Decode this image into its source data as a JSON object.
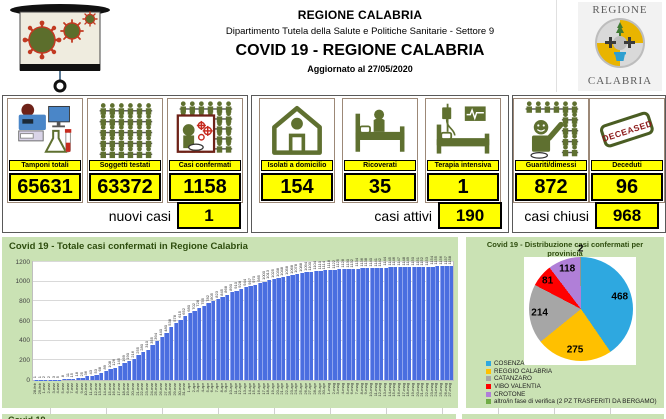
{
  "header": {
    "org": "REGIONE CALABRIA",
    "dept": "Dipartimento Tutela della Salute e Politiche Sanitarie - Settore 9",
    "title": "COVID 19 - REGIONE CALABRIA",
    "updated": "Aggiornato al  27/05/2020",
    "logo_top": "REGIONE",
    "logo_bottom": "CALABRIA"
  },
  "colors": {
    "accent_yellow": "#ffff00",
    "panel_green": "#cae2b4",
    "icon_olive": "#5f7030",
    "stamp_red": "#8c1a1a"
  },
  "stat_groups": [
    {
      "boxes": [
        {
          "label": "Tamponi totali",
          "value": "65631",
          "icon": "lab-equipment-icon"
        },
        {
          "label": "Soggetti testati",
          "value": "63372",
          "icon": "people-grid-icon"
        },
        {
          "label": "Casi confermati",
          "value": "1158",
          "icon": "coughing-person-icon"
        }
      ],
      "summary": {
        "label": "nuovi casi",
        "value": "1"
      }
    },
    {
      "boxes": [
        {
          "label": "Isolati a domicilio",
          "value": "154",
          "icon": "house-icon"
        },
        {
          "label": "Ricoverati",
          "value": "35",
          "icon": "hospital-bed-icon"
        },
        {
          "label": "Terapia intensiva",
          "value": "1",
          "icon": "intensive-care-icon"
        }
      ],
      "summary": {
        "label": "casi attivi",
        "value": "190"
      }
    },
    {
      "boxes": [
        {
          "label": "Guariti/dimessi",
          "value": "872",
          "icon": "recovered-person-icon"
        },
        {
          "label": "Deceduti",
          "value": "96",
          "icon": "deceased-stamp-icon"
        }
      ],
      "summary": {
        "label": "casi chiusi",
        "value": "968"
      }
    }
  ],
  "chart_data": [
    {
      "type": "bar",
      "title": "Covid 19 - Totale casi confermati in Regione Calabria",
      "ylim": [
        0,
        1200
      ],
      "ytick_step": 200,
      "grid": true,
      "data_labels": true,
      "bar_color": "#4a6ee0",
      "categories": [
        "28-feb",
        "29-feb",
        "1-mar",
        "2-mar",
        "3-mar",
        "4-mar",
        "5-mar",
        "6-mar",
        "7-mar",
        "8-mar",
        "9-mar",
        "10-mar",
        "11-mar",
        "12-mar",
        "13-mar",
        "14-mar",
        "15-mar",
        "16-mar",
        "17-mar",
        "18-mar",
        "19-mar",
        "20-mar",
        "21-mar",
        "22-mar",
        "23-mar",
        "24-mar",
        "25-mar",
        "26-mar",
        "27-mar",
        "28-mar",
        "29-mar",
        "30-mar",
        "31-mar",
        "1-apr",
        "2-apr",
        "3-apr",
        "4-apr",
        "5-apr",
        "6-apr",
        "7-apr",
        "8-apr",
        "9-apr",
        "10-apr",
        "11-apr",
        "12-apr",
        "13-apr",
        "14-apr",
        "15-apr",
        "16-apr",
        "17-apr",
        "18-apr",
        "19-apr",
        "20-apr",
        "21-apr",
        "22-apr",
        "23-apr",
        "24-apr",
        "25-apr",
        "26-apr",
        "27-apr",
        "28-apr",
        "29-apr",
        "30-apr",
        "1-mag",
        "2-mag",
        "3-mag",
        "4-mag",
        "5-mag",
        "6-mag",
        "7-mag",
        "8-mag",
        "9-mag",
        "10-mag",
        "11-mag",
        "12-mag",
        "13-mag",
        "14-mag",
        "15-mag",
        "16-mag",
        "17-mag",
        "18-mag",
        "19-mag",
        "20-mag",
        "21-mag",
        "22-mag",
        "23-mag",
        "24-mag",
        "25-mag",
        "26-mag",
        "27-mag"
      ],
      "values": [
        1,
        1,
        2,
        2,
        3,
        5,
        8,
        11,
        15,
        18,
        25,
        36,
        43,
        53,
        68,
        89,
        108,
        126,
        145,
        169,
        190,
        216,
        255,
        280,
        310,
        355,
        394,
        440,
        480,
        538,
        578,
        615,
        652,
        680,
        702,
        728,
        755,
        782,
        805,
        823,
        845,
        868,
        890,
        910,
        928,
        944,
        957,
        970,
        985,
        1000,
        1013,
        1025,
        1038,
        1048,
        1058,
        1068,
        1078,
        1088,
        1094,
        1100,
        1104,
        1110,
        1114,
        1118,
        1122,
        1125,
        1128,
        1130,
        1132,
        1134,
        1136,
        1138,
        1140,
        1141,
        1142,
        1144,
        1145,
        1146,
        1147,
        1148,
        1149,
        1150,
        1151,
        1152,
        1153,
        1154,
        1155,
        1156,
        1157,
        1158
      ]
    },
    {
      "type": "pie",
      "title_line1": "Covid 19 - Distribuzione casi confermati per",
      "title_line2": "provinicia",
      "labels": [
        "COSENZA",
        "REGGIO CALABRIA",
        "CATANZARO",
        "VIBO VALENTIA",
        "CROTONE",
        "altro/in fase di verifica (2 PZ TRASFERITI DA BERGAMO)"
      ],
      "values": [
        468,
        275,
        214,
        81,
        118,
        2
      ],
      "colors": [
        "#2ea8e0",
        "#ffc000",
        "#a6a6a6",
        "#ff0000",
        "#b07fd8",
        "#70ad47"
      ],
      "legend_position": "bottom-left"
    }
  ],
  "footer": {
    "partial_title": "Covid 19 -"
  }
}
